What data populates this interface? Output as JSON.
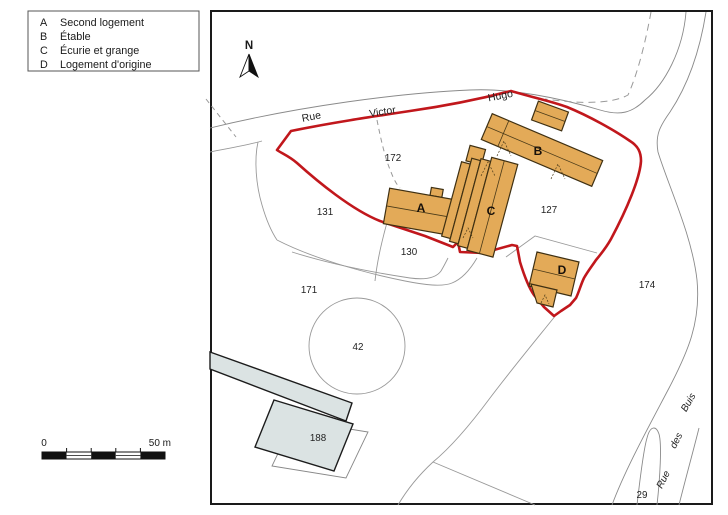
{
  "canvas": {
    "width": 728,
    "height": 515,
    "background": "#ffffff"
  },
  "legend": {
    "items": [
      {
        "key": "A",
        "label": "Second logement"
      },
      {
        "key": "B",
        "label": "Étable"
      },
      {
        "key": "C",
        "label": "Écurie et grange"
      },
      {
        "key": "D",
        "label": "Logement d'origine"
      }
    ]
  },
  "compass": {
    "label": "N"
  },
  "scale_bar": {
    "start_label": "0",
    "end_label": "50 m"
  },
  "streets": {
    "victor_hugo": {
      "word1": "Rue",
      "word2": "Victor",
      "word3": "Hugo"
    },
    "des_buis": {
      "word1": "Rue",
      "word2": "des",
      "word3": "Buis"
    }
  },
  "buildings": {
    "a": "A",
    "b": "B",
    "c": "C",
    "d": "D"
  },
  "parcels": {
    "p172": "172",
    "p131": "131",
    "p130": "130",
    "p171": "171",
    "p127": "127",
    "p42": "42",
    "p174": "174",
    "p188": "188",
    "p29": "29"
  },
  "colors": {
    "building_fill": "#e3aa58",
    "building_stroke": "#3f3012",
    "boundary_red": "#c1171c",
    "parcel_line": "#999999",
    "grey_building_fill": "#dbe3e3",
    "grey_building_stroke": "#1c1c1c",
    "frame": "#1a1a1a"
  }
}
